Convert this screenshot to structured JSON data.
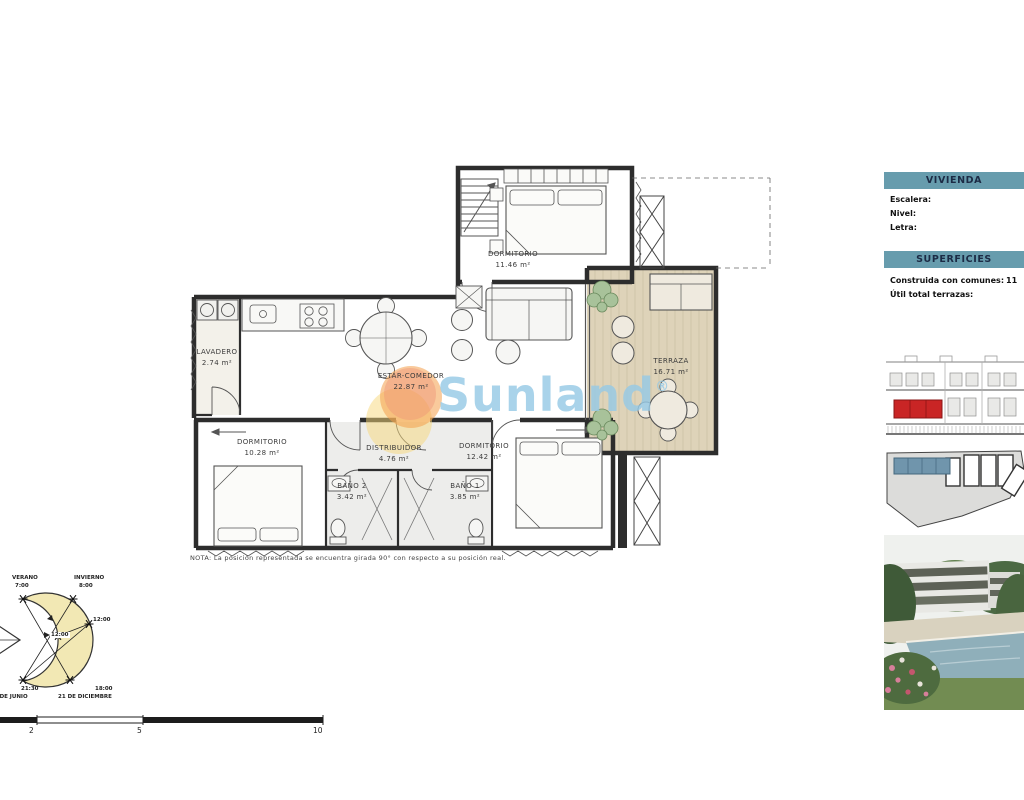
{
  "sidebar": {
    "vivienda_header": "VIVIENDA",
    "fields": [
      {
        "label": "Escalera:"
      },
      {
        "label": "Nivel:"
      },
      {
        "label": "Letra:"
      }
    ],
    "superficies_header": "SUPERFICIES",
    "superficies": [
      {
        "label": "Construida con comunes:",
        "value": "11"
      },
      {
        "label": "Útil total terrazas:",
        "value": ""
      }
    ]
  },
  "plan": {
    "rooms": [
      {
        "name": "DORMITORIO",
        "area": "11.46 m²"
      },
      {
        "name": "LAVADERO",
        "area": "2.74 m²"
      },
      {
        "name": "ESTAR-COMEDOR",
        "area": "22.87 m²"
      },
      {
        "name": "TERRAZA",
        "area": "16.71 m²"
      },
      {
        "name": "DORMITORIO",
        "area": "10.28 m²"
      },
      {
        "name": "DISTRIBUIDOR",
        "area": "4.76 m²"
      },
      {
        "name": "DORMITORIO",
        "area": "12.42 m²"
      },
      {
        "name": "BAÑO 2",
        "area": "3.42 m²"
      },
      {
        "name": "BAÑO 1",
        "area": "3.85 m²"
      }
    ],
    "note": "NOTA: La posición representada se encuentra girada 90° con respecto a su posición real.",
    "watermark": {
      "text": "Sunland",
      "reg": "®"
    }
  },
  "sun_diagram": {
    "verano_label": "VERANO",
    "verano_time": "7:00",
    "invierno_label": "INVIERNO",
    "invierno_time": "8:00",
    "noon_right": "12:00",
    "noon_center": "12:00",
    "sunset_summer": "21:30",
    "sunset_winter": "18:00",
    "date_summer": "21 DE JUNIO",
    "date_winter": "21 DE DICIEMBRE"
  },
  "scale_bar": {
    "ticks": [
      "2",
      "5",
      "10"
    ]
  },
  "colors": {
    "header_bar": "#679cad",
    "header_text": "#1c2b45",
    "highlight_unit_red": "#c92525",
    "highlight_unit_blue": "#7095ac",
    "watermark_blue": "#96c9e5",
    "watermark_orange": "#f49e4a",
    "sun_crescent": "#f2e8b4",
    "terrace_wood": "#ded3b9",
    "wall": "#2d2d2d"
  }
}
